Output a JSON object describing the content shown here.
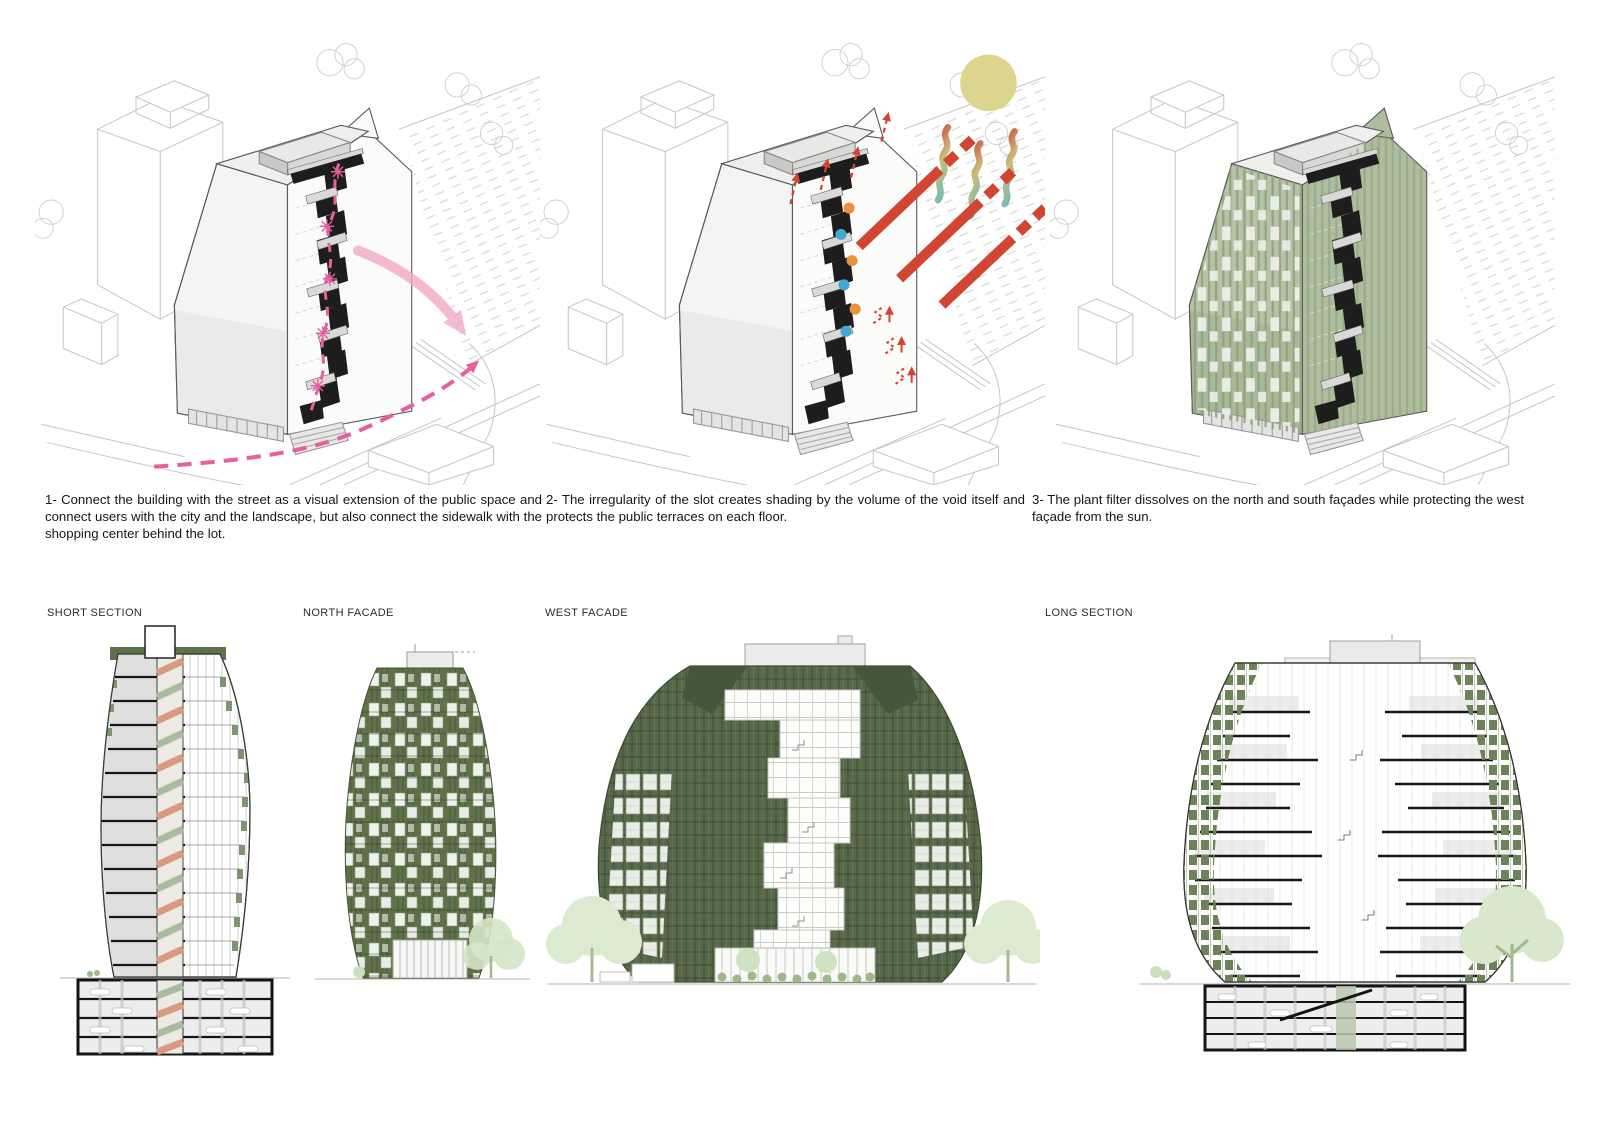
{
  "colors": {
    "accent-pink": "#e75f9e",
    "accent-pink-light": "#f2a9c8",
    "sun-yellow": "#ddd48d",
    "ray-red": "#d24533",
    "dot-orange": "#e8923a",
    "dot-blue": "#45a8d4",
    "plant-green-dark": "#5e7149",
    "plant-green-mid": "#7f9570",
    "plant-green-light": "#b6c3a6",
    "core-salmon": "#d99b80",
    "core-sage": "#a9bba1",
    "drawing-line": "#c6c6c6",
    "ink": "#1d1d1d"
  },
  "concepts": [
    {
      "caption": "1- Connect the building with the street as a visual extension of the public space and connect users with the city and the landscape, but also connect the sidewalk with the shopping center behind the lot."
    },
    {
      "caption": "2- The irregularity of the slot creates shading by the volume of the void itself and protects the public terraces on each floor."
    },
    {
      "caption": "3- The plant filter dissolves on the north and south façades while protecting the west façade from the sun."
    }
  ],
  "drawings": [
    {
      "label": "SHORT SECTION"
    },
    {
      "label": "NORTH FACADE"
    },
    {
      "label": "WEST FACADE"
    },
    {
      "label": "LONG SECTION"
    }
  ]
}
